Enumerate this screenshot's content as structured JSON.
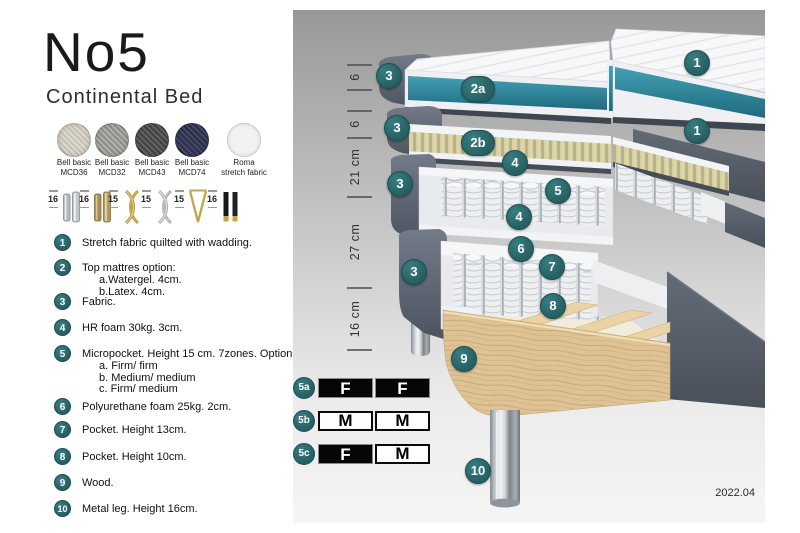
{
  "header": {
    "title": "No5",
    "subtitle": "Continental Bed"
  },
  "swatches": [
    {
      "line1": "Bell basic",
      "line2": "MCD36",
      "color": "#d8d3c9"
    },
    {
      "line1": "Bell basic",
      "line2": "MCD32",
      "color": "#a8a6a1"
    },
    {
      "line1": "Bell basic",
      "line2": "MCD43",
      "color": "#5d5c5a"
    },
    {
      "line1": "Bell basic",
      "line2": "MCD74",
      "color": "#3e4259"
    },
    {
      "line1": "Roma",
      "line2": "stretch fabric",
      "color": "#f2f2f2"
    }
  ],
  "legs": [
    {
      "height": "16",
      "type": "cylinder-silver"
    },
    {
      "height": "16",
      "type": "cylinder-brass"
    },
    {
      "height": "15",
      "type": "twist-gold"
    },
    {
      "height": "15",
      "type": "twist-silver"
    },
    {
      "height": "15",
      "type": "hairpin-gold"
    },
    {
      "height": "16",
      "type": "black-gold"
    }
  ],
  "list": [
    {
      "num": "1",
      "text": "Stretch fabric quilted with wadding."
    },
    {
      "num": "2",
      "text": "Top mattres option:",
      "subs": [
        "a.Watergel. 4cm.",
        "b.Latex. 4cm."
      ]
    },
    {
      "num": "3",
      "text": "Fabric."
    },
    {
      "num": "4",
      "text": "HR foam 30kg. 3cm."
    },
    {
      "num": "5",
      "text": "Micropocket. Height 15 cm. 7zones. Option:",
      "subs": [
        "a. Firm/ firm",
        "b. Medium/ medium",
        "c. Firm/ medium"
      ]
    },
    {
      "num": "6",
      "text": "Polyurethane foam 25kg. 2cm."
    },
    {
      "num": "7",
      "text": "Pocket. Height 13cm."
    },
    {
      "num": "8",
      "text": "Pocket. Height 10cm."
    },
    {
      "num": "9",
      "text": "Wood."
    },
    {
      "num": "10",
      "text": "Metal leg. Height 16cm."
    }
  ],
  "diagram": {
    "ruler": {
      "segments": [
        {
          "label": "6"
        },
        {
          "label": "6"
        },
        {
          "label": "21 cm"
        },
        {
          "label": "27 cm"
        },
        {
          "label": "16 cm"
        }
      ]
    },
    "callouts": [
      {
        "label": "3"
      },
      {
        "label": "2a"
      },
      {
        "label": "1"
      },
      {
        "label": "3"
      },
      {
        "label": "2b"
      },
      {
        "label": "1"
      },
      {
        "label": "4"
      },
      {
        "label": "5"
      },
      {
        "label": "3"
      },
      {
        "label": "4"
      },
      {
        "label": "6"
      },
      {
        "label": "3"
      },
      {
        "label": "7"
      },
      {
        "label": "8"
      },
      {
        "label": "9"
      },
      {
        "label": "10"
      }
    ],
    "firmness_table": {
      "rows": [
        {
          "label": "5a",
          "cells": [
            {
              "value": "F",
              "filled": true
            },
            {
              "value": "F",
              "filled": true
            }
          ]
        },
        {
          "label": "5b",
          "cells": [
            {
              "value": "M",
              "filled": false
            },
            {
              "value": "M",
              "filled": false
            }
          ]
        },
        {
          "label": "5c",
          "cells": [
            {
              "value": "F",
              "filled": true
            },
            {
              "value": "M",
              "filled": false
            }
          ]
        }
      ]
    },
    "version": "2022.04",
    "colors": {
      "callout": "#2b6c6f",
      "teal_core": "#2e8398",
      "fabric_gray": "#59616c",
      "latex": "#d9d4a5",
      "wood": "#dfc394"
    }
  }
}
